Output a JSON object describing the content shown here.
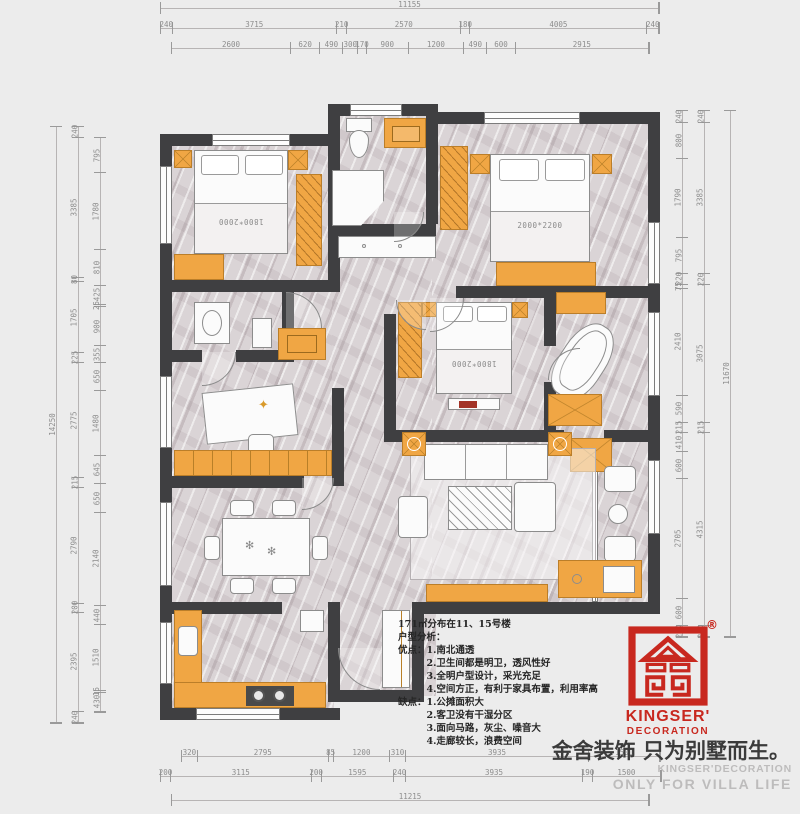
{
  "icons": {
    "fan": "✻",
    "star": "✦"
  },
  "colors": {
    "brand_red": "#c8281f",
    "furniture_orange": "#f0a644",
    "wall_dark": "#3f3f41"
  },
  "plan": {
    "beds": {
      "top_left": "1800*2000",
      "top_right": "2000*2200",
      "middle": "1800*2000"
    }
  },
  "analysis": {
    "area_line": "171㎡分布在11、15号楼",
    "title": "户型分析：",
    "pros_label": "优点：",
    "pros": [
      "1.南北通透",
      "2.卫生间都是明卫，透风性好",
      "3.全明户型设计，采光充足",
      "4.空间方正，有利于家具布置，利用率高"
    ],
    "cons_label": "缺点：",
    "cons": [
      "1.公摊面积大",
      "2.客卫没有干湿分区",
      "3.面向马路，灰尘、噪音大",
      "4.走廊较长，浪费空间"
    ]
  },
  "branding": {
    "registered": "®",
    "logo_word1": "KINGSER'",
    "logo_word2": "DECORATION",
    "tagline": "金舍装饰 只为别墅而生。",
    "watermark1": "KINGSER'DECORATION",
    "watermark2": "ONLY FOR VILLA LIFE"
  },
  "dimensions": {
    "top": {
      "row1": [
        "11155"
      ],
      "row2": [
        "240",
        "3715",
        "210",
        "2570",
        "180",
        "4005",
        "240"
      ],
      "row3": [
        "2600",
        "620",
        "490",
        "300",
        "170",
        "900",
        "1200",
        "490",
        "600",
        "2915"
      ]
    },
    "bottom": {
      "row1": [
        "320",
        "2795",
        "85",
        "1200",
        "310",
        "3935",
        "1500"
      ],
      "row2": [
        "200",
        "3115",
        "200",
        "1595",
        "240",
        "3935",
        "190",
        "1500"
      ],
      "row3": [
        "11215"
      ]
    },
    "left": {
      "outer": [
        "14250"
      ],
      "mid": [
        "240",
        "3385",
        "80",
        "1705",
        "225",
        "2775",
        "215",
        "2790",
        "200",
        "2395",
        "240"
      ],
      "inner": [
        "795",
        "1780",
        "810",
        "425",
        "25",
        "900",
        "355",
        "650",
        "1480",
        "645",
        "650",
        "2140",
        "440",
        "1510",
        "15",
        "430"
      ]
    },
    "right": {
      "inner": [
        "240",
        "800",
        "1790",
        "795",
        "220",
        "75",
        "2410",
        "590",
        "215",
        "410",
        "600",
        "2705",
        "600",
        "220"
      ],
      "mid": [
        "240",
        "3385",
        "220",
        "3075",
        "215",
        "4315",
        "220"
      ],
      "outer": [
        "11670"
      ]
    }
  }
}
